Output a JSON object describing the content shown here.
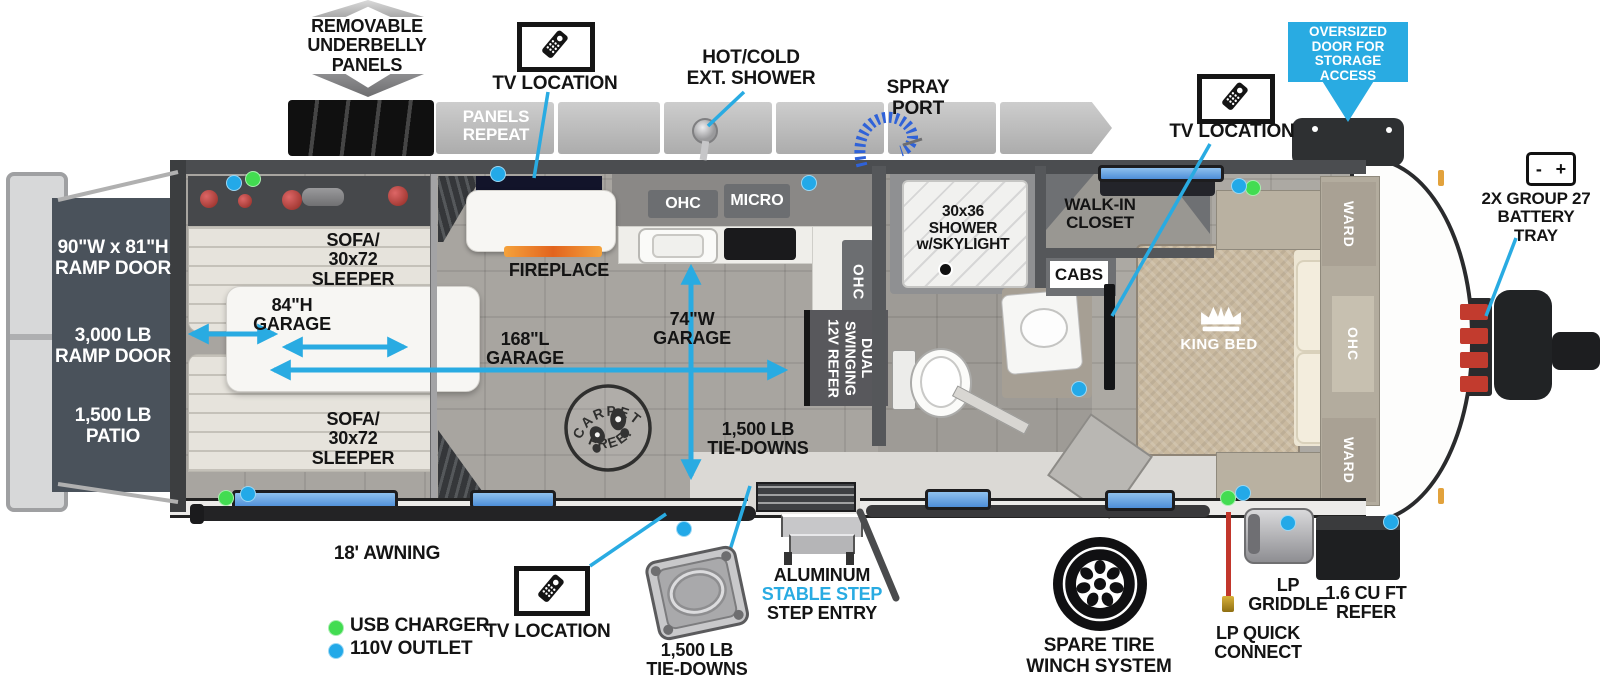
{
  "colors": {
    "accent_blue": "#29ABE2",
    "usb_green": "#42DC51",
    "outlet_blue": "#23A9E8",
    "label_black": "#141414",
    "wall_gray": "#4B4D50"
  },
  "top": {
    "underbelly": "REMOVABLE\nUNDERBELLY\nPANELS",
    "panels_repeat": "PANELS\nREPEAT",
    "ext_shower": "HOT/COLD\nEXT. SHOWER",
    "spray_port": "SPRAY\nPORT",
    "oversized_door": "OVERSIZED\nDOOR FOR\nSTORAGE\nACCESS",
    "battery_label": "2X GROUP 27\nBATTERY\nTRAY",
    "battery_minus": "-",
    "battery_plus": "+"
  },
  "shared": {
    "tv_location": "TV LOCATION",
    "ohc": "OHC",
    "ward": "WARD",
    "sofa_sleeper": "SOFA/\n30x72 SLEEPER",
    "tie_downs": "1,500 LB\nTIE-DOWNS"
  },
  "left_side": {
    "ramp_size": "90\"W x 81\"H\nRAMP DOOR",
    "ramp_weight": "3,000 LB\nRAMP DOOR",
    "patio": "1,500 LB\nPATIO"
  },
  "garage": {
    "height": "84\"H\nGARAGE",
    "length": "168\"L\nGARAGE",
    "width": "74\"W\nGARAGE",
    "fireplace": "FIREPLACE",
    "stamp_top": "CARPET",
    "stamp_bottom": "FREE!"
  },
  "kitchen": {
    "micro": "MICRO",
    "refer": "DUAL\nSWINGING\n12V REFER"
  },
  "bath": {
    "shower": "30x36\nSHOWER\nw/SKYLIGHT",
    "walk_in": "WALK-IN\nCLOSET",
    "cabs": "CABS"
  },
  "bedroom": {
    "king_bed": "KING BED"
  },
  "bottom": {
    "awning": "18' AWNING",
    "legend_usb": "USB CHARGER",
    "legend_outlet": "110V OUTLET",
    "step_line1": "ALUMINUM",
    "step_line2": "STABLE STEP",
    "step_line3": "STEP ENTRY",
    "spare_tire": "SPARE TIRE\nWINCH SYSTEM",
    "lp_quick": "LP QUICK\nCONNECT",
    "lp_griddle": "LP\nGRIDDLE",
    "refer_16": "1.6 CU FT\nREFER"
  },
  "dots": {
    "usb": [
      [
        252,
        178
      ],
      [
        225,
        497
      ],
      [
        1252,
        187
      ],
      [
        1227,
        497
      ]
    ],
    "outlet": [
      [
        233,
        182
      ],
      [
        247,
        493
      ],
      [
        497,
        173
      ],
      [
        808,
        182
      ],
      [
        1238,
        185
      ],
      [
        1078,
        388
      ],
      [
        1242,
        492
      ],
      [
        683,
        528
      ],
      [
        1287,
        522
      ],
      [
        1390,
        521
      ]
    ]
  }
}
